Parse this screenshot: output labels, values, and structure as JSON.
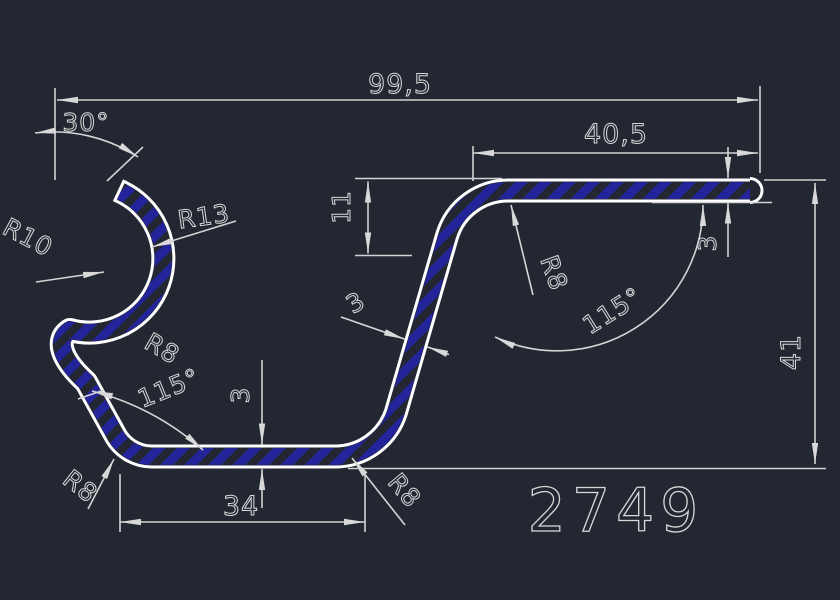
{
  "drawing": {
    "background": "#232731",
    "line_color": "#d4d4d4",
    "profile_color": "#ffffff",
    "hatch_color": "#24249a",
    "part_number": "2749",
    "dimensions": {
      "overall_width": "99,5",
      "top_flange_width": "40,5",
      "tip_angle": "30°",
      "curl_inner_radius": "R10",
      "curl_outer_radius": "R13",
      "top_bend_radius": "R8",
      "left_bend_radius": "R8",
      "bottom_left_radius": "R8",
      "bottom_right_radius": "R8",
      "right_angle": "115°",
      "left_angle": "115°",
      "flange_drop": "11",
      "thickness_right": "3",
      "thickness_leg": "3",
      "thickness_base": "3",
      "base_width": "34",
      "overall_height": "41"
    }
  }
}
